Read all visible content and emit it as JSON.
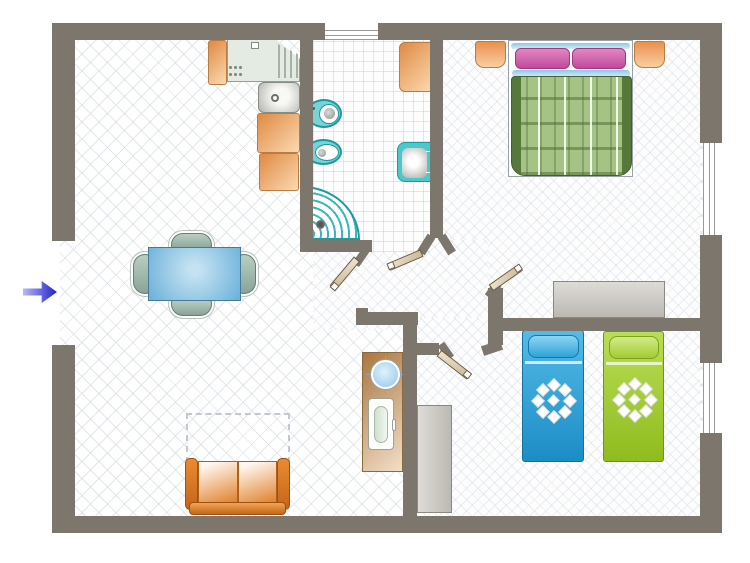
{
  "diagram": {
    "type": "apartment-floor-plan",
    "entry": {
      "symbol": "blue-arrow",
      "direction": "right",
      "location": "left-wall-gap"
    },
    "rooms": [
      {
        "name": "living-dining-room",
        "furniture": [
          "dining-table",
          "dining-chair-top",
          "dining-chair-bottom",
          "dining-chair-left",
          "dining-chair-right",
          "sofa",
          "dashed-rug-outline",
          "desk",
          "desk-globe",
          "desk-chair"
        ]
      },
      {
        "name": "kitchen",
        "furniture": [
          "cabinet-top",
          "cooktop-counter",
          "corner-drainer",
          "sink",
          "cabinet-mid",
          "cabinet-low"
        ]
      },
      {
        "name": "bathroom",
        "furniture": [
          "toilet",
          "bidet",
          "corner-shower",
          "washbasin",
          "bath-cabinet"
        ],
        "window": "top-wall"
      },
      {
        "name": "master-bedroom",
        "furniture": [
          "double-bed",
          "pillow-left",
          "pillow-right",
          "nightstand-left",
          "nightstand-right",
          "wardrobe"
        ],
        "window": "right-wall-upper"
      },
      {
        "name": "kids-bedroom",
        "furniture": [
          "single-bed-blue",
          "single-bed-green",
          "wardrobe-tall"
        ],
        "window": "right-wall-lower"
      }
    ],
    "doors": [
      "hallway-door",
      "bathroom-door",
      "master-bedroom-door",
      "kids-bedroom-door"
    ],
    "windows": [
      "bathroom-window",
      "master-bedroom-window",
      "kids-bedroom-window"
    ]
  },
  "palette": {
    "wall": "#7d766d",
    "floor_line": "#dfe4e9",
    "teal_fixture": "#2fb3ba",
    "cabinet_orange": "#e8914d",
    "bed_green": "#a6c386",
    "pillow_pink": "#d063ae",
    "kid_bed_blue": "#2ba1dc",
    "kid_bed_green": "#a3cb32",
    "sofa_orange": "#e08430",
    "table_blue": "#6fb3da",
    "door_leaf": "#d9c9ab",
    "arrow_blue": "#2020c8",
    "wardrobe_gray": "#cccac4"
  }
}
